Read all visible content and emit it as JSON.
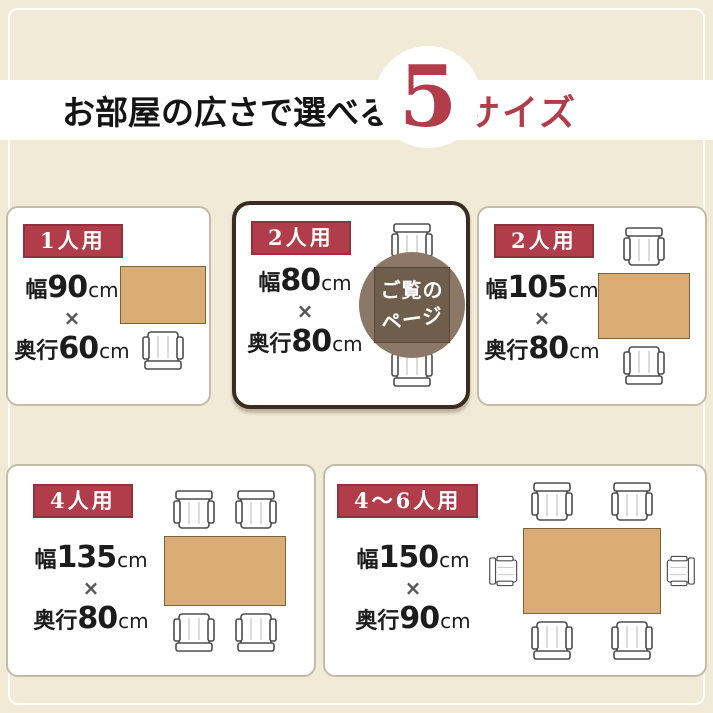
{
  "colors": {
    "bg": "#f0ead6",
    "accent_red": "#b13c4a",
    "badge_border": "#93303d",
    "table_fill": "#d9ad75",
    "table_border": "#7d6138",
    "overlay_circle": "#8b7867",
    "overlay_square": "#6f5e4c",
    "highlight_border": "#3a2c20"
  },
  "header": {
    "title_main": "お部屋の広さで選べる",
    "title_number": "5",
    "title_suffix": "サイズ"
  },
  "cards": [
    {
      "badge": "1人用",
      "width_label": "幅",
      "width_value": "90",
      "unit": "cm",
      "times": "×",
      "depth_label": "奥行",
      "depth_value": "60"
    },
    {
      "badge": "2人用",
      "width_label": "幅",
      "width_value": "80",
      "unit": "cm",
      "times": "×",
      "depth_label": "奥行",
      "depth_value": "80",
      "overlay": {
        "line1": "ご覧の",
        "line2": "ページ"
      }
    },
    {
      "badge": "2人用",
      "width_label": "幅",
      "width_value": "105",
      "unit": "cm",
      "times": "×",
      "depth_label": "奥行",
      "depth_value": "80"
    },
    {
      "badge": "4人用",
      "width_label": "幅",
      "width_value": "135",
      "unit": "cm",
      "times": "×",
      "depth_label": "奥行",
      "depth_value": "80"
    },
    {
      "badge": "4〜6人用",
      "width_label": "幅",
      "width_value": "150",
      "unit": "cm",
      "times": "×",
      "depth_label": "奥行",
      "depth_value": "90"
    }
  ]
}
